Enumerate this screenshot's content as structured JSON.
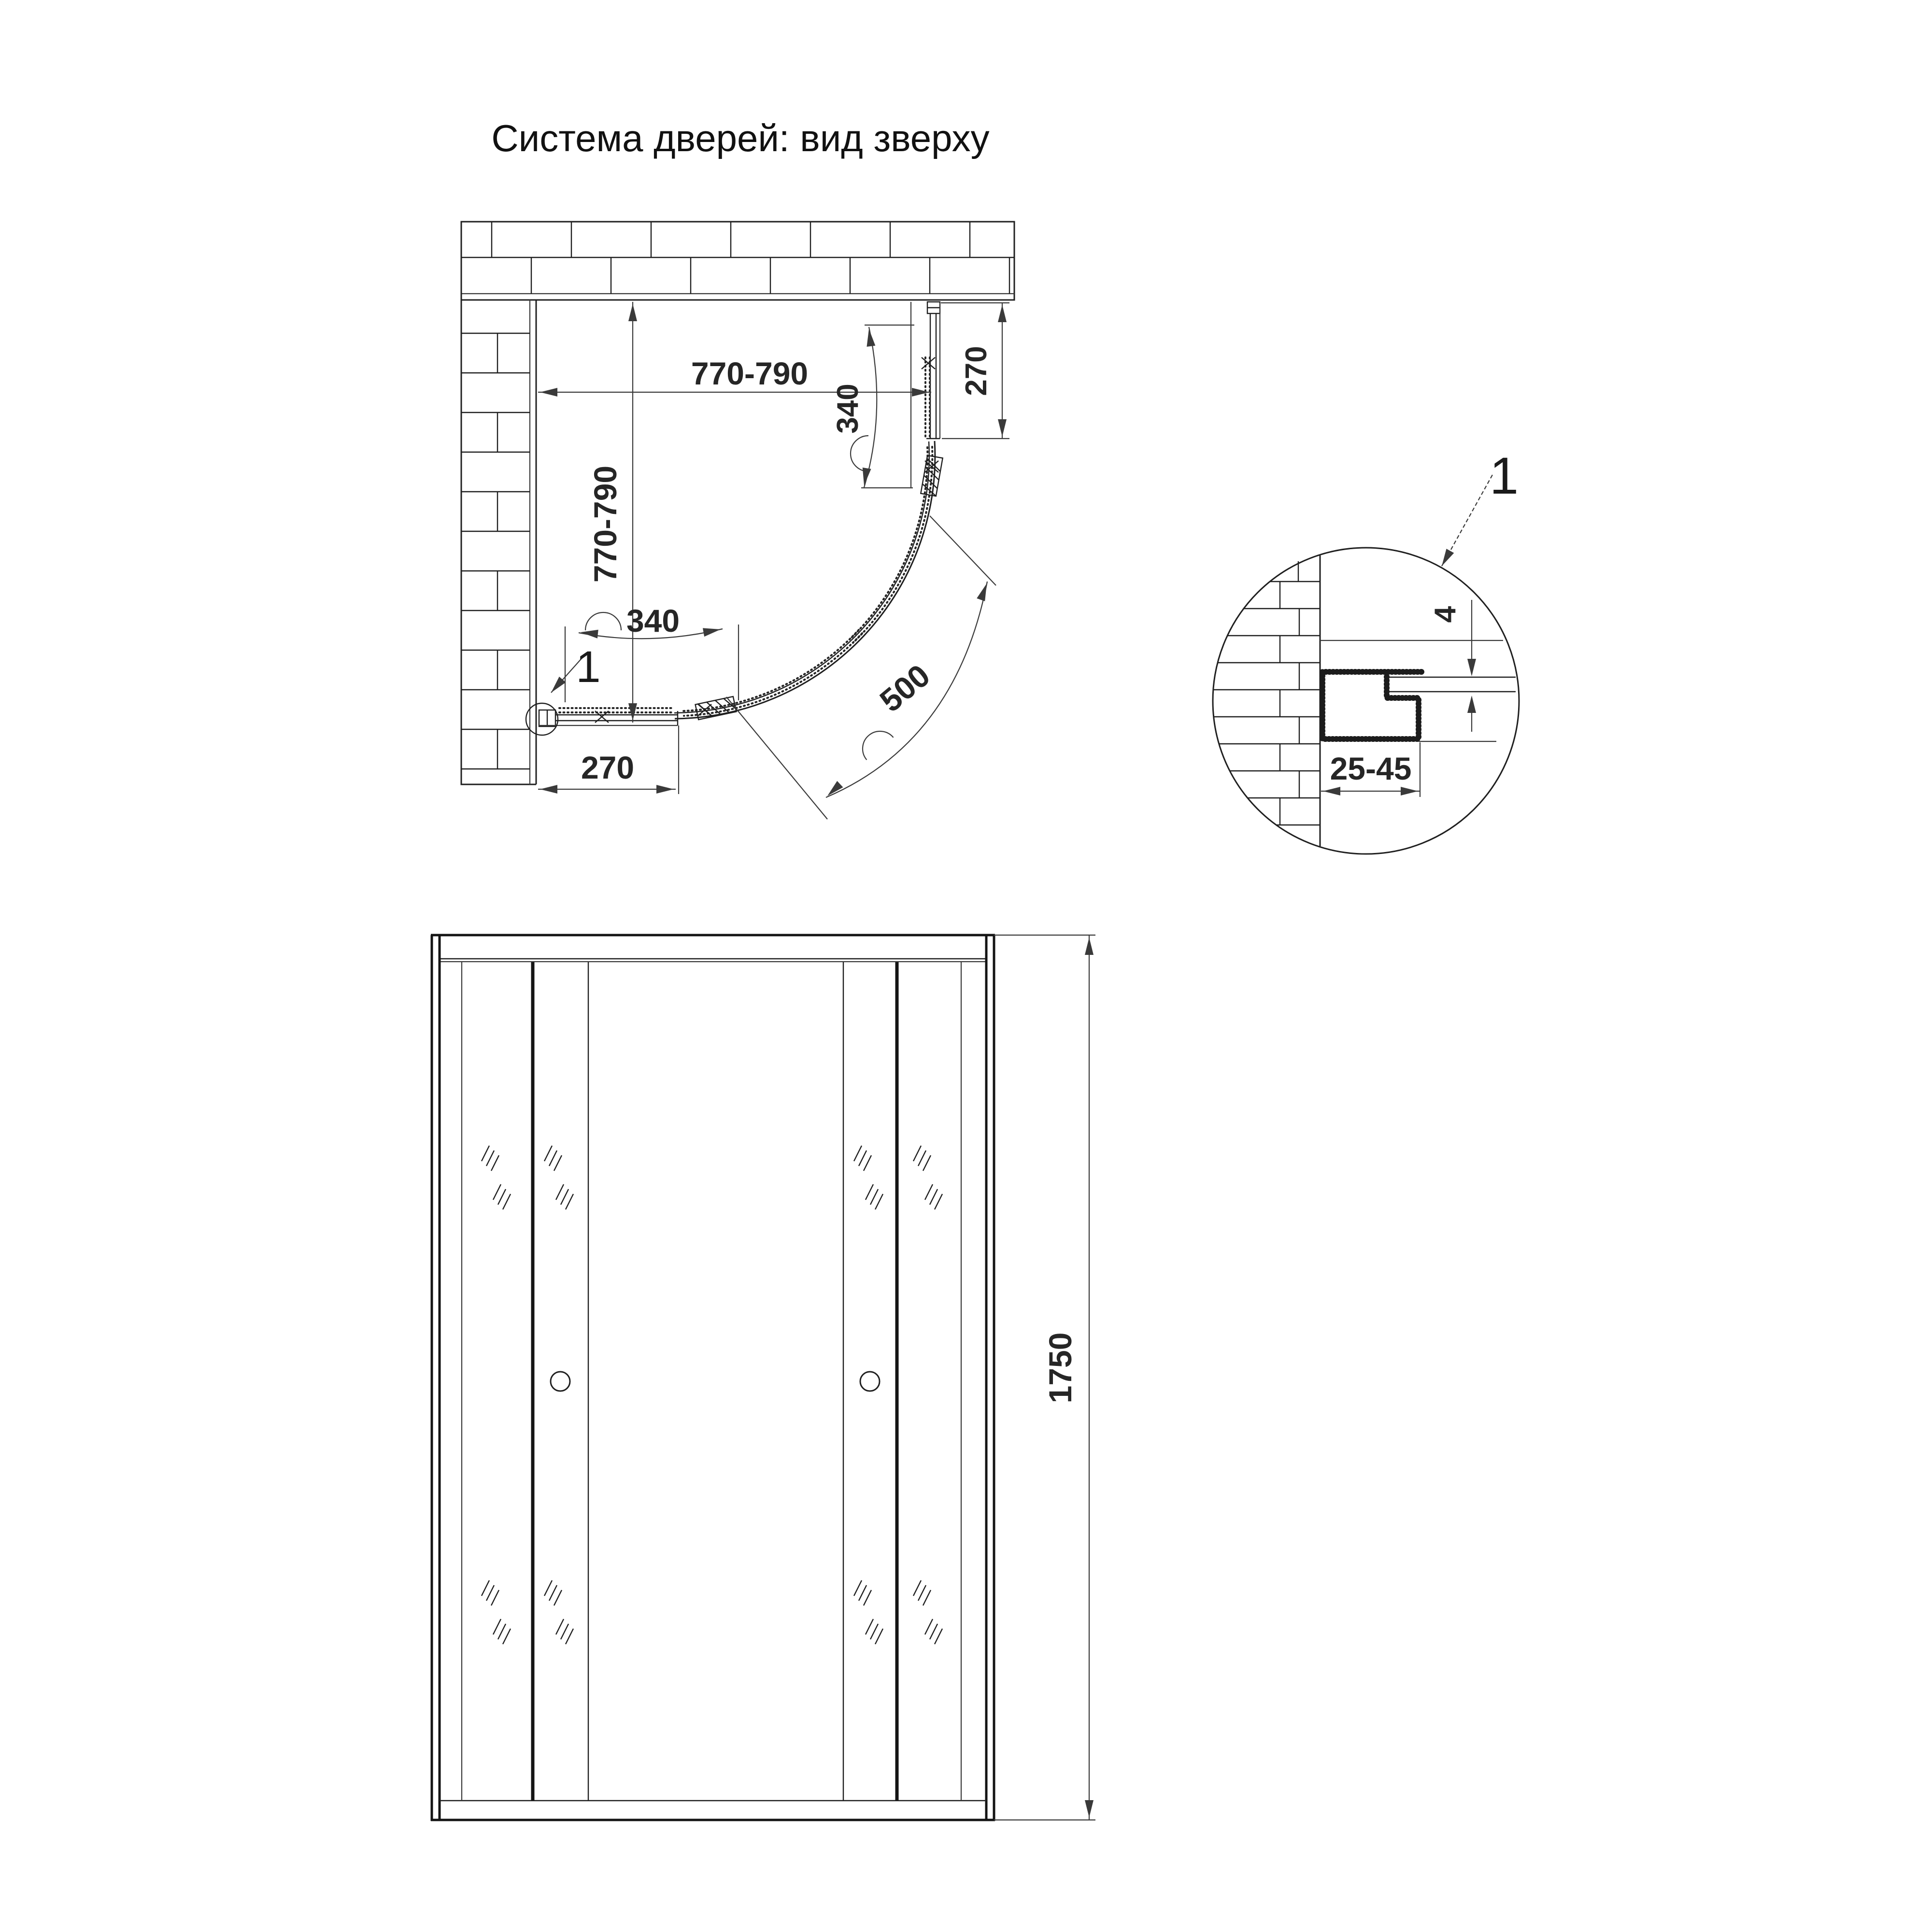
{
  "title": "Система дверей: вид зверху",
  "top_view": {
    "dim_width": "770-790",
    "dim_depth": "770-790",
    "dim_door_right": "340",
    "dim_fixed_right": "270",
    "dim_door_bottom": "340",
    "dim_fixed_bottom": "270",
    "dim_arc_opening": "500",
    "callout_label": "1"
  },
  "detail_view": {
    "callout_label": "1",
    "dim_glass_thickness": "4",
    "dim_profile_depth": "25-45"
  },
  "front_view": {
    "dim_height": "1750"
  },
  "colors": {
    "line": "#1f1f1f",
    "dimension": "#3a3a3a",
    "background": "#ffffff"
  }
}
